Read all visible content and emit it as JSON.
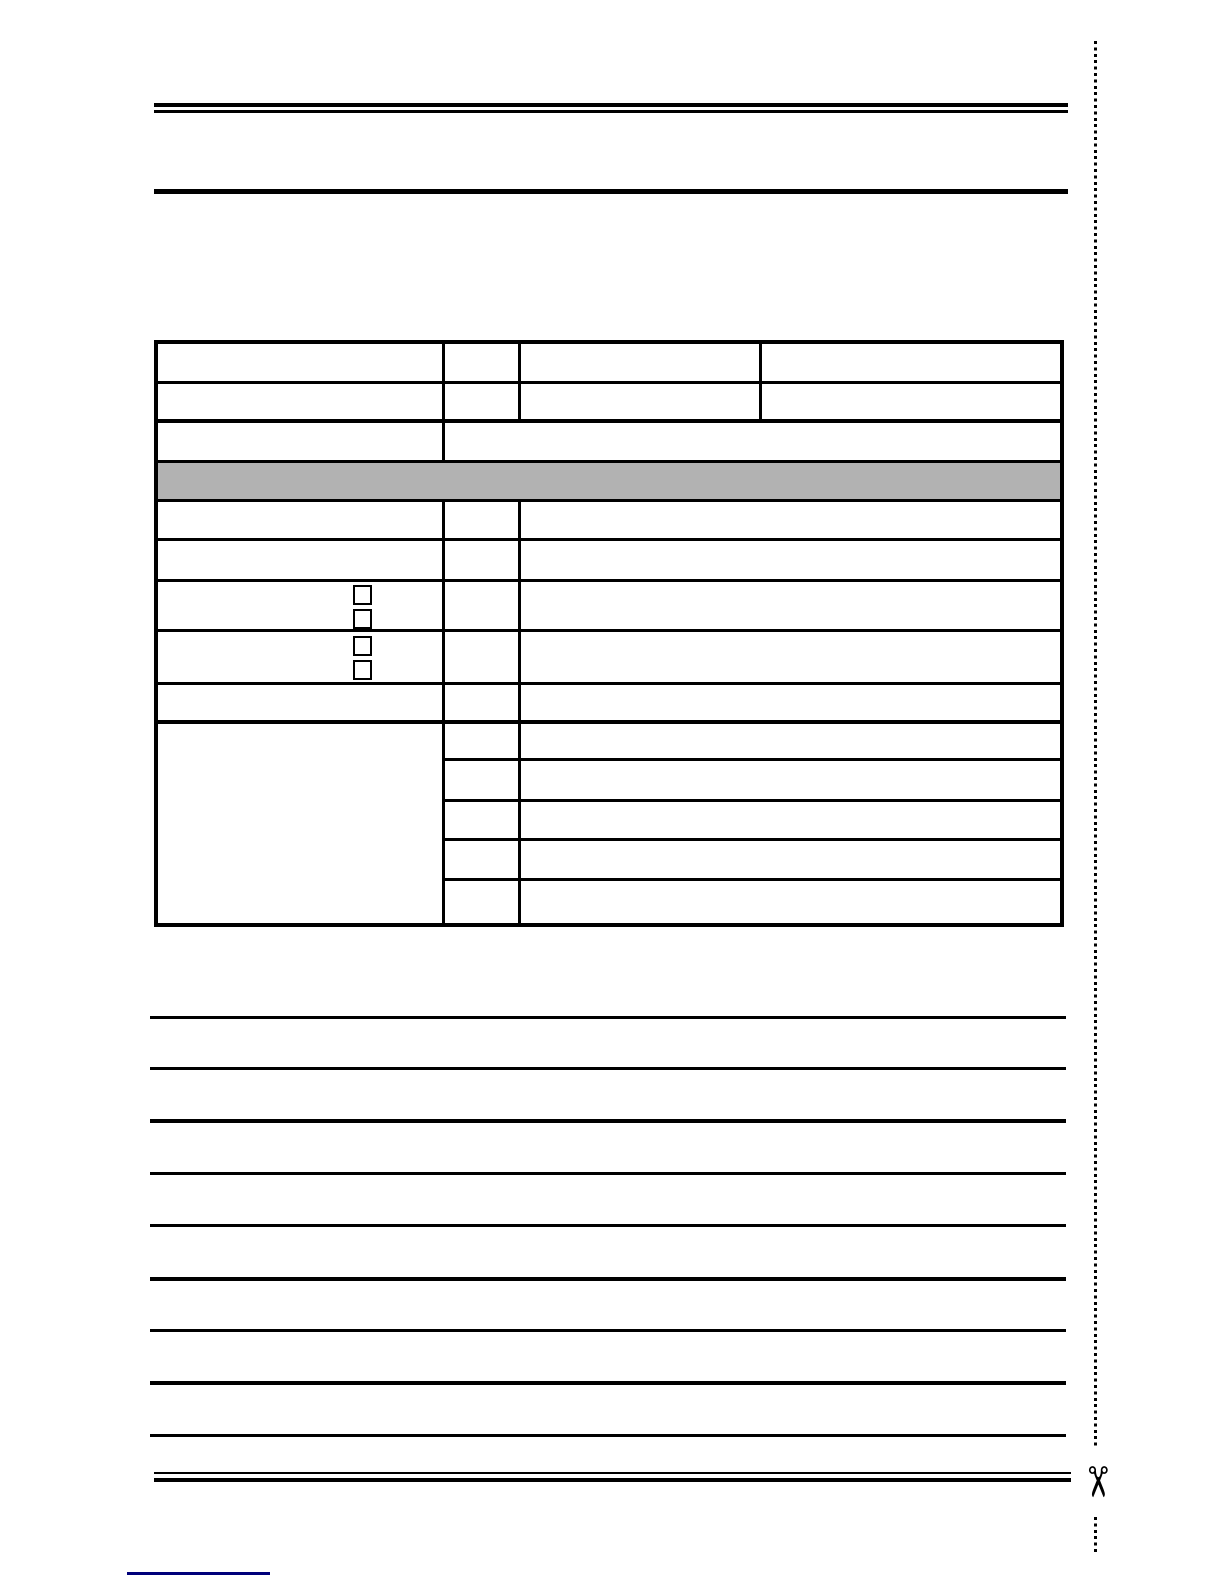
{
  "colors": {
    "ink": "#000000",
    "banner_fill": "#b2b2b2",
    "footnote_rule": "#00007a",
    "page_background": "#ffffff"
  },
  "icons": {
    "scissors_glyph": "✂"
  },
  "form_table": {
    "banner_label": "",
    "cell_values": [
      "",
      "",
      "",
      "",
      "",
      "",
      "",
      "",
      "",
      "",
      "",
      "",
      "",
      "",
      "",
      "",
      "",
      ""
    ],
    "checkboxes": [
      {
        "checked": false
      },
      {
        "checked": false
      },
      {
        "checked": false
      },
      {
        "checked": false
      }
    ]
  },
  "writing_lines": {
    "count": 9
  }
}
